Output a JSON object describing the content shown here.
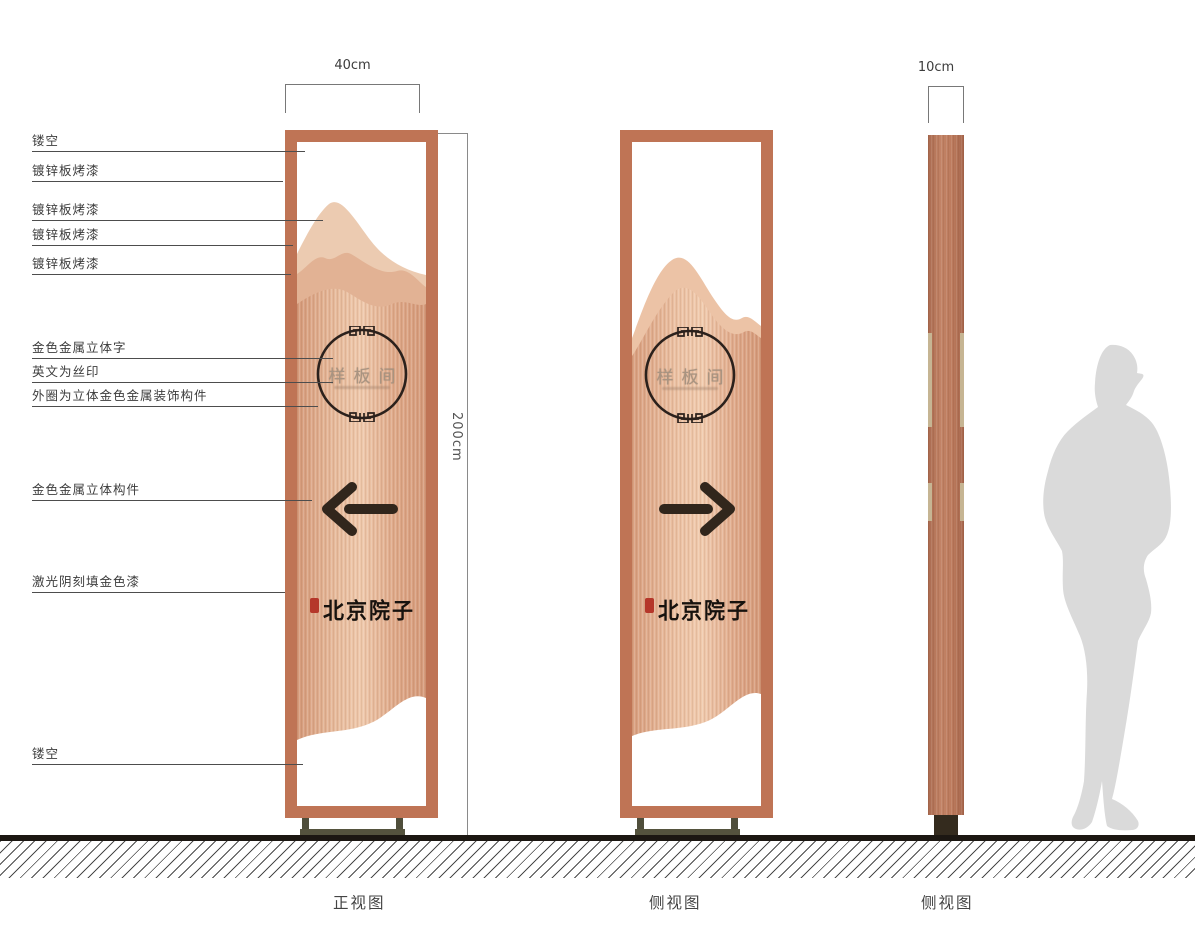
{
  "annotations": [
    {
      "label": "镂空"
    },
    {
      "label": "镀锌板烤漆"
    },
    {
      "label": "镀锌板烤漆"
    },
    {
      "label": "镀锌板烤漆"
    },
    {
      "label": "镀锌板烤漆"
    },
    {
      "label": "金色金属立体字"
    },
    {
      "label": "英文为丝印"
    },
    {
      "label": "外圈为立体金色金属装饰构件"
    },
    {
      "label": "金色金属立体构件"
    },
    {
      "label": "激光阴刻填金色漆"
    },
    {
      "label": "镂空"
    }
  ],
  "dimensions": {
    "front_width": "40cm",
    "height": "200cm",
    "side_width": "10cm"
  },
  "sign": {
    "emblem_text": "样板间",
    "logo_text": "北京院子"
  },
  "view_labels": {
    "front": "正视图",
    "side_mid": "侧视图",
    "side_thin": "侧视图"
  },
  "colors": {
    "frame_copper": "#bf7455",
    "panel_body": "#e7bb9c",
    "mountain_back": "#eccbb1",
    "mountain_mid": "#e2b294",
    "arrow_dark": "#31261c",
    "seal_red": "#b5372a",
    "silhouette_gray": "#dadada"
  }
}
